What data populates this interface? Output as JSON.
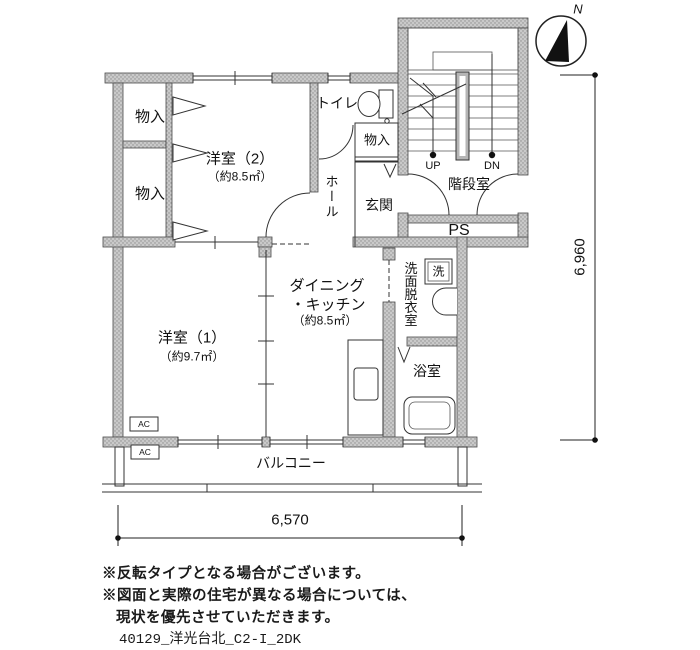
{
  "compass": {
    "north_label": "N"
  },
  "rooms": {
    "closet_top": "物入",
    "closet_bottom": "物入",
    "western2_name": "洋室（2）",
    "western2_area": "（約8.5㎡）",
    "toilet": "トイレ",
    "entry_closet": "物入",
    "hall": "ホール",
    "entrance": "玄関",
    "stairwell": "階段室",
    "pipe_space": "PS",
    "up_label": "UP",
    "down_label": "DN",
    "dk_line1": "ダイニング",
    "dk_line2": "・キッチン",
    "dk_area": "（約8.5㎡）",
    "western1_name": "洋室（1）",
    "western1_area": "（約9.7㎡）",
    "washroom": "洗面脱衣室",
    "washer_box": "洗",
    "bathroom": "浴室",
    "balcony": "バルコニー",
    "ac_unit1": "AC",
    "ac_unit2": "AC"
  },
  "dimensions": {
    "horizontal": "6,570",
    "vertical": "6,960"
  },
  "notes": [
    "※反転タイプとなる場合がございます。",
    "※図面と実際の住宅が異なる場合については、",
    "現状を優先させていただきます。"
  ],
  "footer": "40129_洋光台北_C2-I_2DK",
  "colors": {
    "wall_fill": "#c9c9c9",
    "wall_dot": "#8f8f8f",
    "line": "#333333",
    "background": "#ffffff"
  }
}
